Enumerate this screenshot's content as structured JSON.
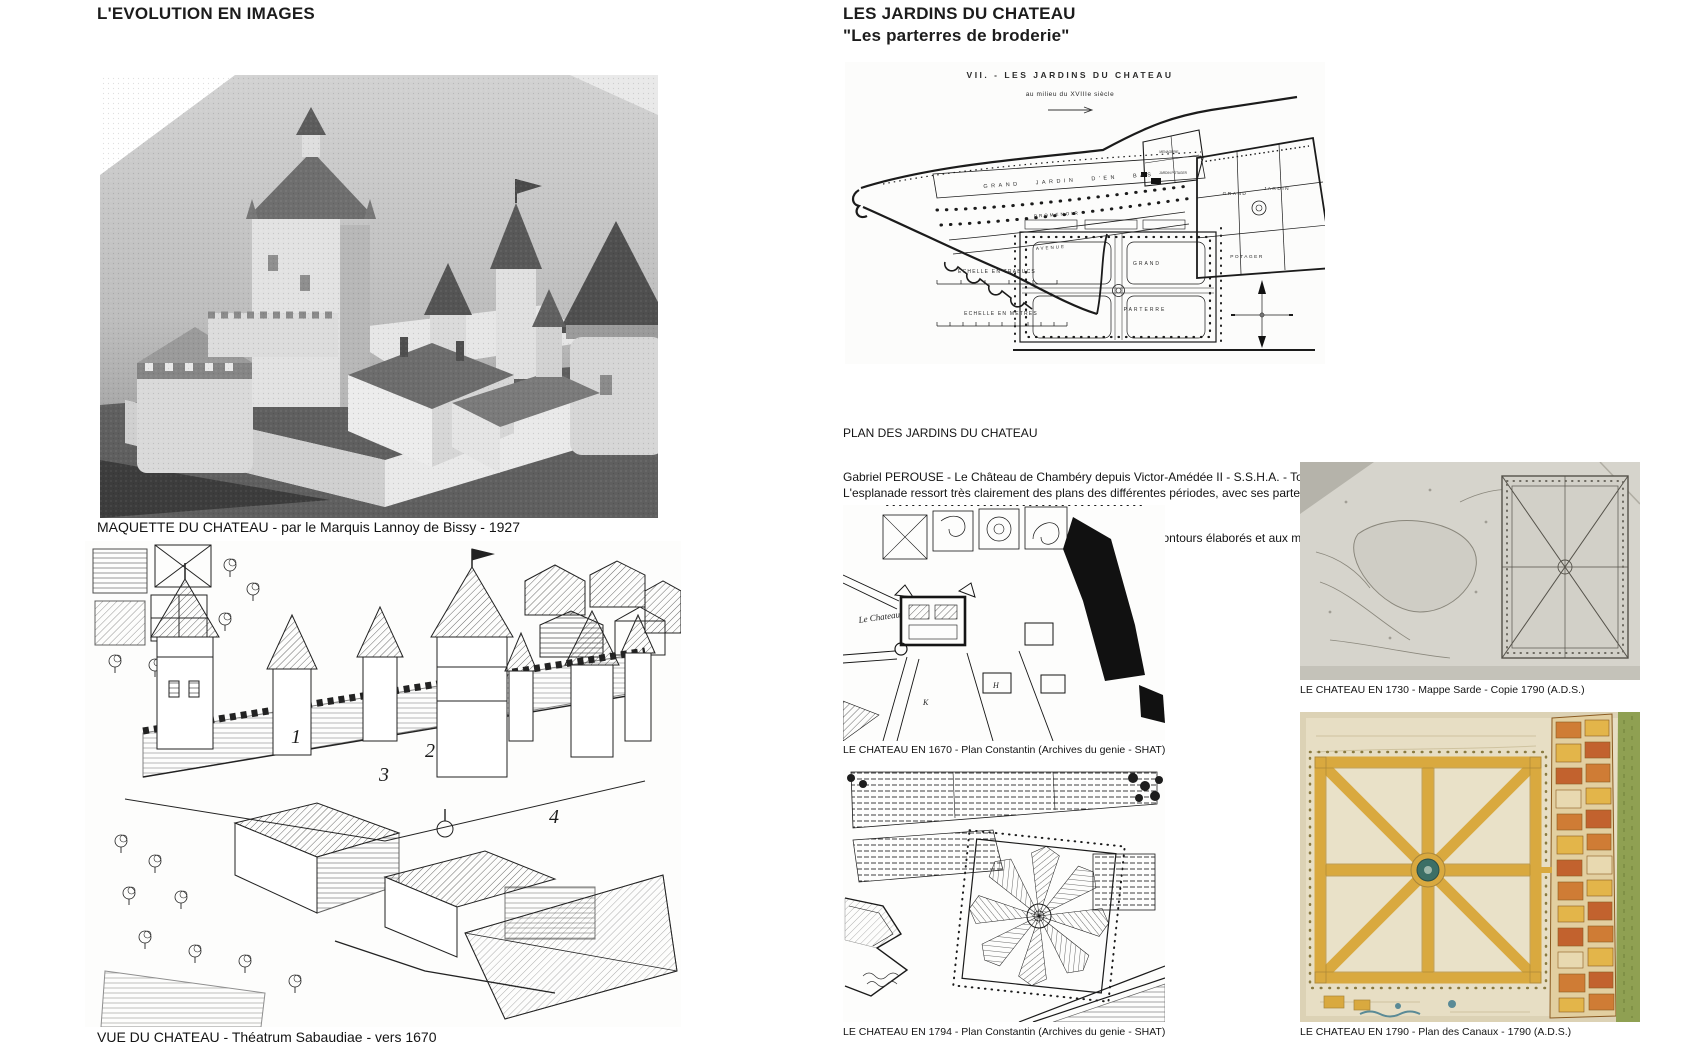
{
  "left": {
    "title": "L'EVOLUTION EN IMAGES",
    "figure1": {
      "caption": "MAQUETTE DU CHATEAU - par le Marquis Lannoy de Bissy - 1927"
    },
    "figure2": {
      "caption": "VUE DU CHATEAU - Théatrum Sabaudiae - vers 1670",
      "numbers": {
        "n1": "1",
        "n2": "2",
        "n3": "3",
        "n4": "4"
      }
    }
  },
  "right": {
    "title": "LES JARDINS DU CHATEAU",
    "subtitle": "\"Les parterres de broderie\"",
    "plan": {
      "header": "VII. - LES JARDINS DU CHATEAU",
      "subheader": "au milieu du XVIIIe siècle",
      "labels": {
        "grand_jardin_den_bas": "GRAND JARDIN D'EN BAS",
        "promenoir": "PROMENOIR",
        "avenue": "AVENUE",
        "menagerie": "MENAGERIE",
        "jardin_potager": "JARDIN POTAGER",
        "echelle_trabucs": "ECHELLE EN TRABUCS",
        "echelle_metres": "ECHELLE EN METRES",
        "grand": "GRAND",
        "parterre": "PARTERRE",
        "jardin": "JARDIN",
        "potager": "POTAGER"
      }
    },
    "source_line1": "PLAN DES JARDINS DU CHATEAU",
    "source_line2": "Gabriel PEROUSE - Le Château de Chambéry depuis Victor-Amédée II - S.S.H.A. - Tome XXIII, 1918 -",
    "source_line3": "Pages 211 - 417",
    "para_line1": "L'esplanade ressort très clairement des plans des différentes périodes, avec ses parterres de broderie.",
    "para_line2": "On peut aisément imaginer un jardin impeccable tenu, aux contours élaborés et aux motifs si différents",
    "maps": [
      {
        "caption": "LE CHATEAU EN 1670 - Plan Constantin (Archives du genie - SHAT)",
        "labels": {
          "chateau": "Le Chateau",
          "h": "H",
          "k": "K"
        }
      },
      {
        "caption": "LE CHATEAU EN 1730 - Mappe Sarde - Copie 1790 (A.D.S.)"
      },
      {
        "caption": "LE CHATEAU EN 1794 - Plan Constantin (Archives du genie - SHAT)"
      },
      {
        "caption": "LE CHATEAU EN 1790 - Plan des Canaux - 1790 (A.D.S.)"
      }
    ],
    "colors": {
      "garden_path": "#d9a93f",
      "basin": "#3c6f66",
      "city_block": "#cf7c35",
      "green_strip": "#8fa052",
      "parchment": "#d6d4cc",
      "tan": "#e7dec4"
    }
  }
}
